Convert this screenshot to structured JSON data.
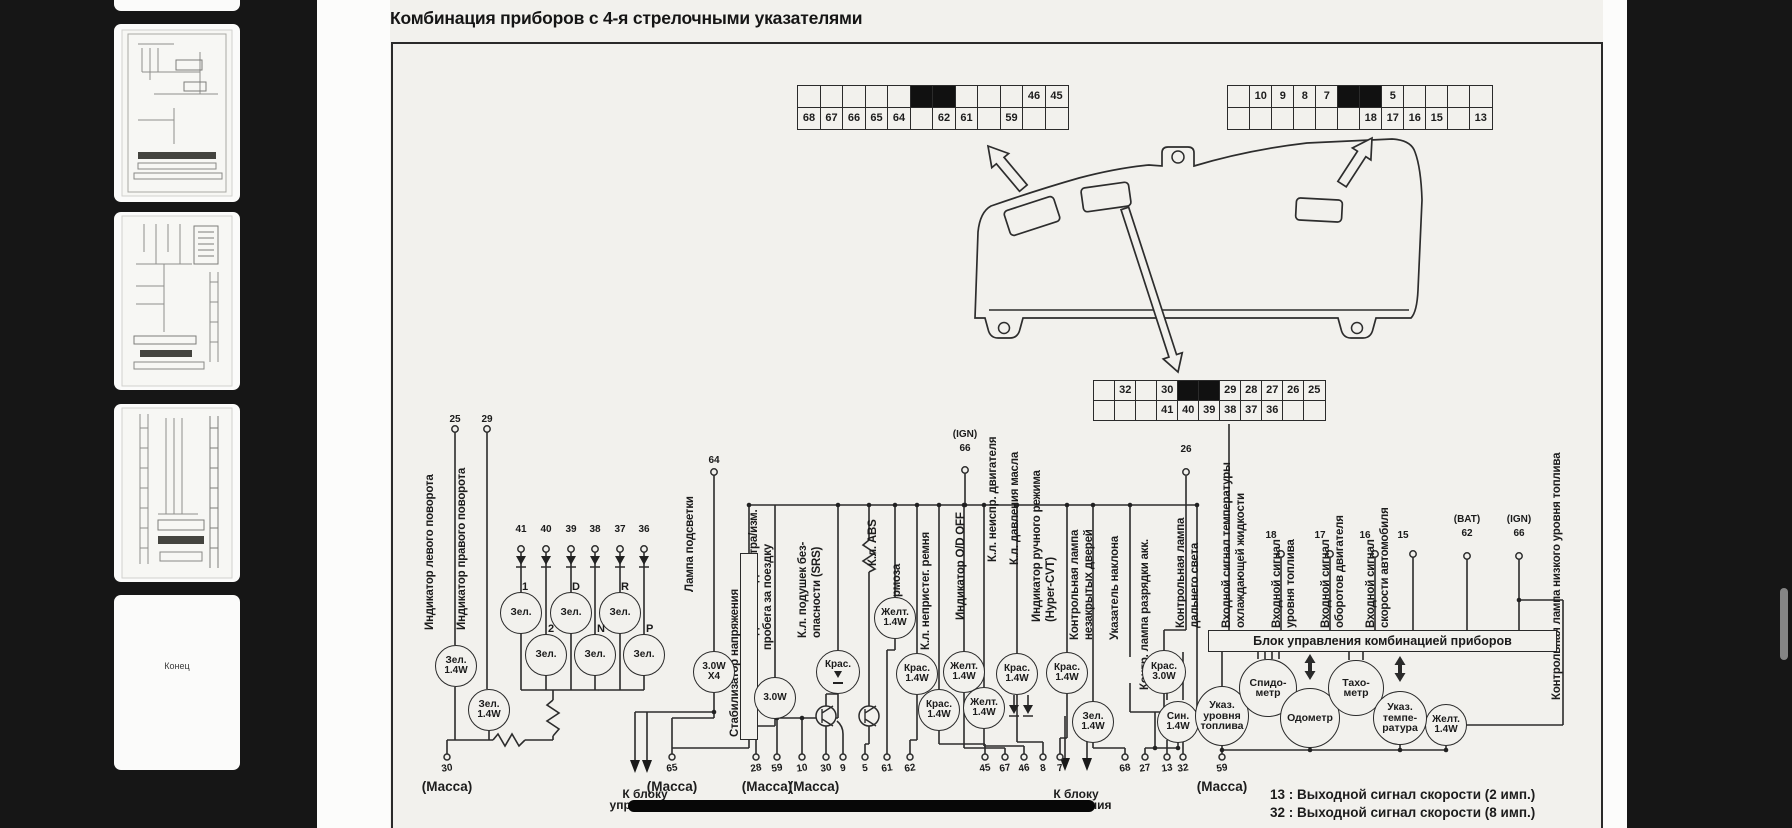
{
  "app": {
    "background": "#161616",
    "scrollbar_color": "#858585"
  },
  "sidebar": {
    "end_page_label": "Конец"
  },
  "doc": {
    "title": "Комбинация приборов с 4-я стрелочными указателями",
    "connector_top_left": {
      "top_row": [
        "",
        "",
        "",
        "",
        "",
        "",
        "",
        "",
        "",
        "",
        "46",
        "45"
      ],
      "bottom_row": [
        "68",
        "67",
        "66",
        "65",
        "64",
        "",
        "62",
        "61",
        "",
        "59",
        "",
        ""
      ]
    },
    "connector_top_right": {
      "top_row": [
        "",
        "10",
        "9",
        "8",
        "7",
        "",
        "",
        "5",
        "",
        "",
        "",
        ""
      ],
      "bottom_row": [
        "",
        "",
        "",
        "",
        "",
        "",
        "18",
        "17",
        "16",
        "15",
        "",
        "13"
      ]
    },
    "connector_middle": {
      "top_row": [
        "",
        "32",
        "",
        "30",
        "",
        "",
        "29",
        "28",
        "27",
        "26",
        "25"
      ],
      "bottom_row": [
        "",
        "",
        "",
        "41",
        "40",
        "39",
        "38",
        "37",
        "36",
        "",
        ""
      ]
    },
    "pins": {
      "left_turn": "25",
      "right_turn": "29",
      "at": [
        "41",
        "40",
        "39",
        "38",
        "37",
        "36"
      ],
      "illumination": "64",
      "ign": "66",
      "ign_tag": "(IGN)",
      "charge": "26",
      "fuel": "18",
      "rpm": "17",
      "speed": "16",
      "p15": "15",
      "bat": "62",
      "bat_tag": "(BAT)"
    },
    "vlabels": [
      "Индикатор левого поворота",
      "Индикатор правого поворота",
      "Лампа подсветки",
      "Подсветка одометра/изм.",
      "пробега за поездку",
      "К.л. подушек без-",
      "опасности (SRS)",
      "К.л. ABS",
      "К.л. тормоза",
      "К.л. непристег. ремня",
      "Индикатор O/D OFF",
      "К.л. неиспр. двигателя",
      "К.л. давления масла",
      "Индикатор ручного режима",
      "(Hyper-CVT)",
      "Контрольная лампа",
      "незакрытых дверей",
      "Указатель наклона",
      "Контр. лампа разрядки акк.",
      "Контрольная лампа",
      "дальнего света",
      "Входной сигнал температуры",
      "охлаждающей жидкости",
      "Входной сигнал",
      "уровня топлива",
      "Входной сигнал",
      "оборотов двигателя",
      "Входной сигнал",
      "скорости автомобиля",
      "Контрольная лампа низкого уровня топлива"
    ],
    "stabilizer": "Стабилизатор напряжения",
    "control_unit": "Блок управления комбинацией приборов",
    "at_letters": [
      "1",
      "D",
      "R",
      "2",
      "N",
      "P"
    ],
    "lamps": [
      {
        "lines": [
          "Зел.",
          "1.4W"
        ]
      },
      {
        "lines": [
          "Зел.",
          "1.4W"
        ]
      },
      {
        "lines": [
          "Зел."
        ]
      },
      {
        "lines": [
          "Зел."
        ]
      },
      {
        "lines": [
          "Зел."
        ]
      },
      {
        "lines": [
          "Зел."
        ]
      },
      {
        "lines": [
          "Зел."
        ]
      },
      {
        "lines": [
          "Зел."
        ]
      },
      {
        "lines": [
          "3.0W",
          "X4"
        ]
      },
      {
        "lines": [
          "3.0W"
        ]
      },
      {
        "lines": [
          "Крас."
        ]
      },
      {
        "lines": [
          "Желт.",
          "1.4W"
        ]
      },
      {
        "lines": [
          "Крас.",
          "1.4W"
        ]
      },
      {
        "lines": [
          "Желт.",
          "1.4W"
        ]
      },
      {
        "lines": [
          "Крас.",
          "1.4W"
        ]
      },
      {
        "lines": [
          "Желт.",
          "1.4W"
        ]
      },
      {
        "lines": [
          "Крас.",
          "1.4W"
        ]
      },
      {
        "lines": [
          "Крас.",
          "1.4W"
        ]
      },
      {
        "lines": [
          "Зел.",
          "1.4W"
        ]
      },
      {
        "lines": [
          "Крас.",
          "3.0W"
        ]
      },
      {
        "lines": [
          "Син.",
          "1.4W"
        ]
      },
      {
        "lines": [
          "Желт.",
          "1.4W"
        ]
      }
    ],
    "gauges": [
      {
        "lines": [
          "Указ.",
          "уровня",
          "топлива"
        ]
      },
      {
        "lines": [
          "Спидо-",
          "метр"
        ]
      },
      {
        "lines": [
          "Одометр"
        ]
      },
      {
        "lines": [
          "Тахо-",
          "метр"
        ]
      },
      {
        "lines": [
          "Указ.",
          "темпе-",
          "ратура"
        ]
      }
    ],
    "bottom_pins": [
      "30",
      "65",
      "28",
      "59",
      "10",
      "30",
      "9",
      "5",
      "61",
      "62",
      "45",
      "67",
      "46",
      "8",
      "7",
      "68",
      "27",
      "13",
      "32",
      "59"
    ],
    "massa": "(Масса)",
    "to_control_unit": [
      "К блоку",
      "управления"
    ],
    "footnotes": [
      "13 : Выходной сигнал скорости (2 имп.)",
      "32 : Выходной сигнал скорости (8 имп.)"
    ]
  }
}
